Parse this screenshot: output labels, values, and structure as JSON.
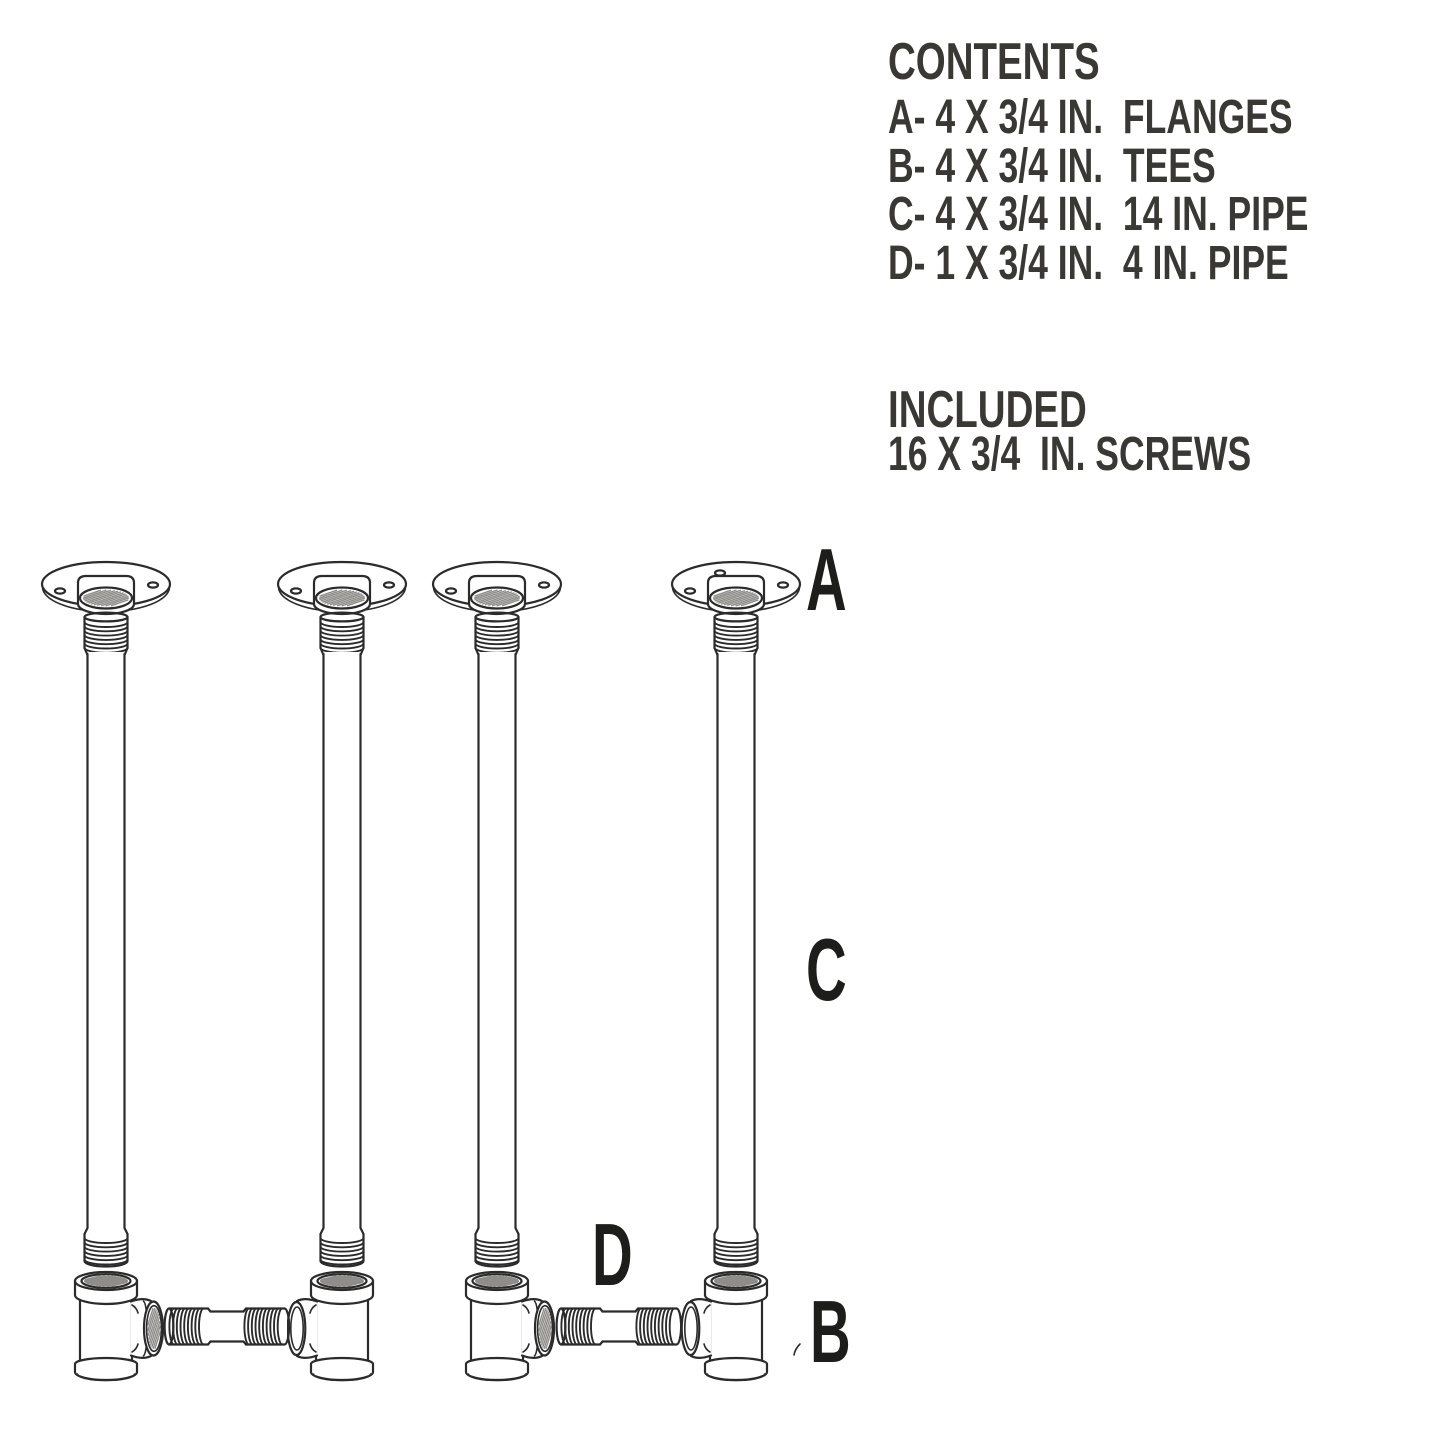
{
  "contents": {
    "title": "CONTENTS",
    "items": [
      "A- 4 X 3/4 IN.  FLANGES",
      "B- 4 X 3/4 IN.  TEES",
      "C- 4 X 3/4 IN.  14 IN. PIPE",
      "D- 1 X 3/4 IN.  4 IN. PIPE"
    ]
  },
  "included": {
    "title": "INCLUDED",
    "items": [
      "16 X 3/4  IN. SCREWS"
    ]
  },
  "diagram": {
    "label_flange": "A",
    "label_pipe": "C",
    "label_short_pipe": "D",
    "label_tee": "B"
  },
  "colors": {
    "background": "#ffffff",
    "line_ink": "#2b2b2b",
    "text_ink": "#3a3835",
    "thread_hatch": "#8f8d8a"
  }
}
